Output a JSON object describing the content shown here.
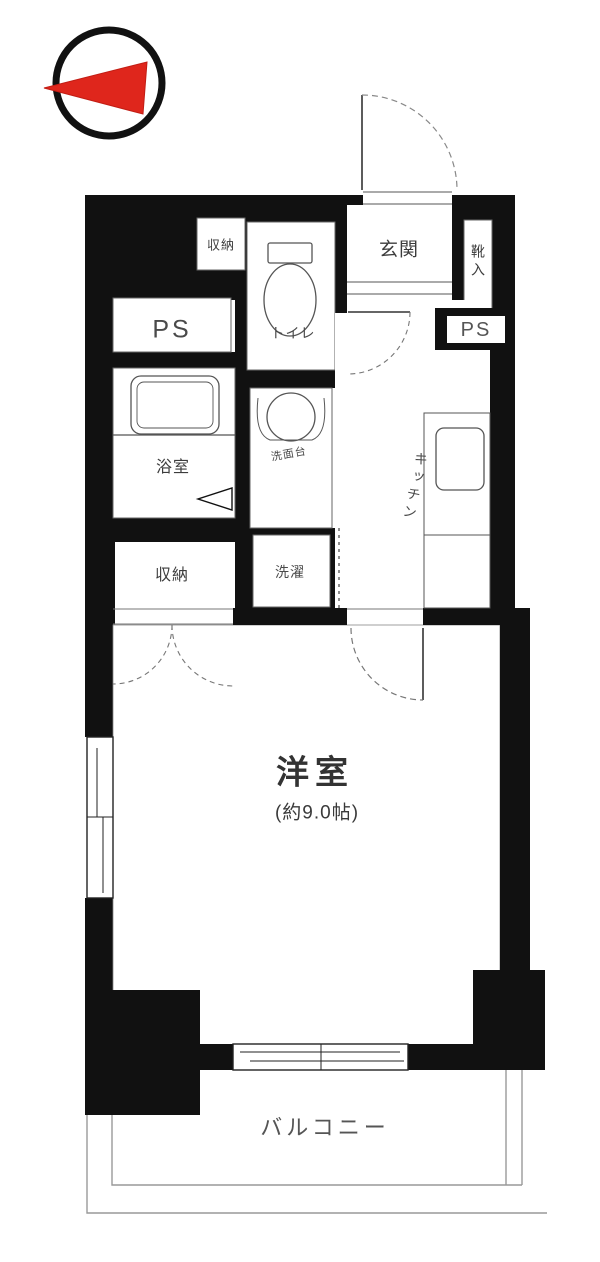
{
  "title": "apartment-floor-plan",
  "compass": {
    "icon": "north-arrow-icon",
    "direction": "left",
    "arrow_color": "#df261c"
  },
  "rooms": {
    "closet_top": {
      "label": "収納"
    },
    "toilet": {
      "label": "トイレ"
    },
    "entrance": {
      "label": "玄関"
    },
    "shoe_cabinet": {
      "label": "靴入"
    },
    "ps_left": {
      "label": "PS"
    },
    "ps_right": {
      "label": "PS"
    },
    "bathroom": {
      "label": "浴室"
    },
    "washbasin": {
      "label": "洗面台"
    },
    "kitchen": {
      "label": "キッチン"
    },
    "closet": {
      "label": "収納"
    },
    "laundry": {
      "label": "洗濯"
    },
    "western_room": {
      "label": "洋室",
      "size": "(約9.0帖)"
    },
    "balcony": {
      "label": "バルコニー"
    }
  },
  "colors": {
    "wall": "#111111",
    "line": "#555555",
    "text": "#3c3c3c",
    "north_red": "#df261c"
  }
}
